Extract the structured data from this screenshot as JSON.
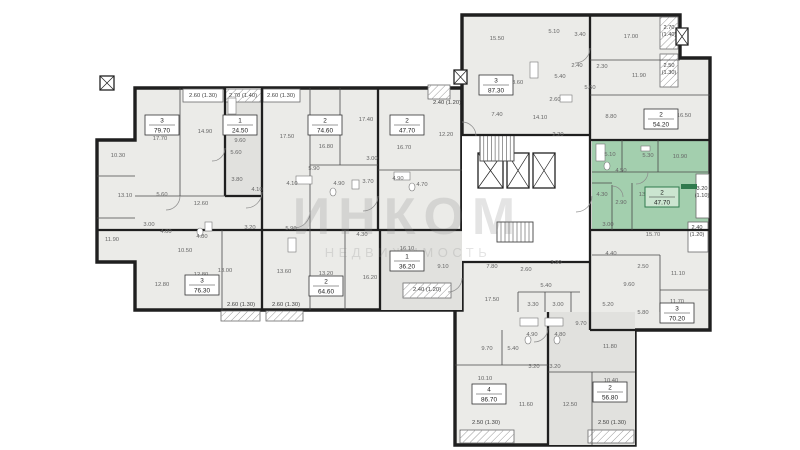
{
  "watermark": {
    "line1": "ИНКОМ",
    "line2": "НЕДВИЖИМОСТЬ"
  },
  "selected_unit": {
    "rooms": "2",
    "area": "47.70"
  },
  "colors": {
    "bg": "#ffffff",
    "wall": "#1f1f1f",
    "thin_wall": "#4a4a4a",
    "apt_fill": "#ebebe8",
    "alt_fill": "#e1e1de",
    "white": "#ffffff",
    "green": "#a3cfae",
    "green_dark": "#2f7a4d",
    "green_box": "#cbe5d0",
    "label": "#666666",
    "dim": "#3f3f3f",
    "watermark": "rgba(130,130,130,0.22)"
  },
  "plan": {
    "outlines": [
      {
        "name": "wing-upper-left",
        "points": "135,88 462,88 462,310 135,310 135,262 97,262 97,140 135,140"
      },
      {
        "name": "wing-right",
        "points": "462,15 680,15 680,58 710,58 710,330 635,330 635,445 455,445 455,310 462,310"
      }
    ],
    "regions": [
      {
        "x": 225,
        "y": 88,
        "w": 37,
        "h": 108,
        "fill": "alt"
      },
      {
        "x": 380,
        "y": 230,
        "w": 82,
        "h": 80,
        "fill": "alt"
      },
      {
        "x": 548,
        "y": 312,
        "w": 87,
        "h": 133,
        "fill": "alt"
      },
      {
        "x": 462,
        "y": 135,
        "w": 128,
        "h": 127,
        "fill": "white"
      },
      {
        "x": 592,
        "y": 140,
        "w": 116,
        "h": 90,
        "fill": "green"
      }
    ],
    "green_accent": {
      "x": 681,
      "y": 184,
      "w": 16,
      "h": 5
    },
    "balconies": [
      {
        "x": 183,
        "y": 89,
        "w": 40,
        "h": 13,
        "hatch": false
      },
      {
        "x": 225,
        "y": 89,
        "w": 36,
        "h": 13,
        "hatch": true
      },
      {
        "x": 263,
        "y": 89,
        "w": 37,
        "h": 13,
        "hatch": false
      },
      {
        "x": 660,
        "y": 17,
        "w": 18,
        "h": 32,
        "hatch": true
      },
      {
        "x": 660,
        "y": 54,
        "w": 18,
        "h": 33,
        "hatch": true
      },
      {
        "x": 428,
        "y": 85,
        "w": 22,
        "h": 14,
        "hatch": true
      },
      {
        "x": 221,
        "y": 311,
        "w": 39,
        "h": 10,
        "hatch": true
      },
      {
        "x": 266,
        "y": 311,
        "w": 37,
        "h": 10,
        "hatch": true
      },
      {
        "x": 403,
        "y": 283,
        "w": 48,
        "h": 15,
        "hatch": true
      },
      {
        "x": 696,
        "y": 174,
        "w": 13,
        "h": 44,
        "hatch": false
      },
      {
        "x": 688,
        "y": 222,
        "w": 20,
        "h": 30,
        "hatch": false
      },
      {
        "x": 460,
        "y": 430,
        "w": 54,
        "h": 13,
        "hatch": true
      },
      {
        "x": 588,
        "y": 430,
        "w": 46,
        "h": 13,
        "hatch": true
      }
    ],
    "shafts": [
      {
        "x": 478,
        "y": 153,
        "w": 25,
        "h": 35
      },
      {
        "x": 507,
        "y": 153,
        "w": 22,
        "h": 35
      },
      {
        "x": 533,
        "y": 153,
        "w": 22,
        "h": 35
      },
      {
        "x": 454,
        "y": 70,
        "w": 13,
        "h": 14
      },
      {
        "x": 100,
        "y": 76,
        "w": 14,
        "h": 14
      },
      {
        "x": 676,
        "y": 28,
        "w": 12,
        "h": 17
      }
    ],
    "stairs": [
      {
        "x": 480,
        "y": 135,
        "w": 34,
        "h": 26,
        "steps": 9
      },
      {
        "x": 497,
        "y": 222,
        "w": 36,
        "h": 20,
        "steps": 9
      }
    ],
    "walls_thick": [
      [
        225,
        88,
        225,
        196
      ],
      [
        262,
        88,
        262,
        310
      ],
      [
        378,
        88,
        378,
        230
      ],
      [
        97,
        230,
        462,
        230
      ],
      [
        380,
        230,
        380,
        310
      ],
      [
        225,
        196,
        262,
        196
      ],
      [
        590,
        15,
        590,
        330
      ],
      [
        462,
        135,
        590,
        135
      ],
      [
        590,
        140,
        710,
        140
      ],
      [
        590,
        230,
        710,
        230
      ],
      [
        462,
        262,
        590,
        262
      ],
      [
        548,
        312,
        548,
        445
      ],
      [
        590,
        330,
        635,
        330
      ]
    ],
    "walls_thin": [
      [
        180,
        88,
        180,
        196
      ],
      [
        310,
        88,
        310,
        230
      ],
      [
        340,
        88,
        340,
        165
      ],
      [
        310,
        165,
        378,
        165
      ],
      [
        378,
        170,
        462,
        170
      ],
      [
        135,
        196,
        225,
        196
      ],
      [
        97,
        176,
        135,
        176
      ],
      [
        97,
        218,
        135,
        218
      ],
      [
        222,
        230,
        222,
        310
      ],
      [
        310,
        230,
        310,
        310
      ],
      [
        345,
        230,
        345,
        310
      ],
      [
        592,
        172,
        708,
        172
      ],
      [
        622,
        140,
        622,
        172
      ],
      [
        658,
        140,
        658,
        172
      ],
      [
        612,
        185,
        612,
        230
      ],
      [
        632,
        183,
        632,
        230
      ],
      [
        592,
        183,
        612,
        183
      ],
      [
        590,
        60,
        680,
        60
      ],
      [
        590,
        95,
        710,
        95
      ],
      [
        518,
        292,
        518,
        312
      ],
      [
        545,
        292,
        545,
        312
      ],
      [
        571,
        292,
        571,
        312
      ],
      [
        518,
        292,
        580,
        292
      ],
      [
        455,
        365,
        548,
        365
      ],
      [
        502,
        330,
        502,
        365
      ],
      [
        548,
        372,
        635,
        372
      ],
      [
        592,
        372,
        592,
        445
      ],
      [
        592,
        255,
        660,
        255
      ],
      [
        660,
        255,
        660,
        312
      ],
      [
        660,
        290,
        710,
        290
      ]
    ],
    "doors": [
      "M262,192 A16,16 0 0 1 246,208",
      "M310,212 A16,16 0 0 1 294,228",
      "M378,196 A15,15 0 0 1 363,211",
      "M592,196 A16,16 0 0 1 576,212",
      "M648,172 A12,12 0 0 1 636,184",
      "M590,48 A15,15 0 0 1 575,63",
      "M548,328 A14,14 0 0 1 534,342",
      "M462,278 A14,14 0 0 1 448,292",
      "M225,148 A13,13 0 0 1 212,161",
      "M462,122 A14,14 0 0 1 476,136",
      "M612,186 A11,11 0 0 1 623,197",
      "M180,196 A14,14 0 0 1 166,210"
    ],
    "fixtures_rects": [
      [
        296,
        176,
        16,
        8
      ],
      [
        394,
        172,
        16,
        8
      ],
      [
        596,
        144,
        9,
        17
      ],
      [
        228,
        98,
        8,
        16
      ],
      [
        288,
        238,
        8,
        14
      ],
      [
        352,
        180,
        7,
        9
      ],
      [
        641,
        146,
        9,
        5
      ],
      [
        205,
        222,
        7,
        9
      ],
      [
        520,
        318,
        18,
        8
      ],
      [
        545,
        318,
        18,
        8
      ],
      [
        530,
        62,
        8,
        16
      ],
      [
        560,
        95,
        12,
        7
      ]
    ],
    "fixtures_ellipses": [
      [
        333,
        192
      ],
      [
        412,
        187
      ],
      [
        607,
        166
      ],
      [
        528,
        340
      ],
      [
        557,
        340
      ],
      [
        200,
        232
      ]
    ],
    "unit_boxes": [
      {
        "unit": "3",
        "area": "79.70",
        "x": 162,
        "y": 125,
        "selected": false
      },
      {
        "unit": "1",
        "area": "24.50",
        "x": 240,
        "y": 125,
        "selected": false
      },
      {
        "unit": "2",
        "area": "74.60",
        "x": 325,
        "y": 125,
        "selected": false
      },
      {
        "unit": "2",
        "area": "47.70",
        "x": 407,
        "y": 125,
        "selected": false
      },
      {
        "unit": "3",
        "area": "76.30",
        "x": 202,
        "y": 285,
        "selected": false
      },
      {
        "unit": "2",
        "area": "64.60",
        "x": 326,
        "y": 286,
        "selected": false
      },
      {
        "unit": "1",
        "area": "36.20",
        "x": 407,
        "y": 261,
        "selected": false
      },
      {
        "unit": "3",
        "area": "87.30",
        "x": 496,
        "y": 85,
        "selected": false
      },
      {
        "unit": "2",
        "area": "54.20",
        "x": 661,
        "y": 119,
        "selected": false
      },
      {
        "unit": "2",
        "area": "47.70",
        "x": 662,
        "y": 197,
        "selected": true
      },
      {
        "unit": "3",
        "area": "70.20",
        "x": 677,
        "y": 313,
        "selected": false
      },
      {
        "unit": "4",
        "area": "86.70",
        "x": 489,
        "y": 394,
        "selected": false
      },
      {
        "unit": "2",
        "area": "56.80",
        "x": 610,
        "y": 392,
        "selected": false
      }
    ],
    "room_labels": [
      [
        "10.30",
        118,
        157
      ],
      [
        "13.10",
        125,
        197
      ],
      [
        "11.90",
        112,
        241
      ],
      [
        "17.70",
        160,
        140
      ],
      [
        "14.90",
        205,
        133
      ],
      [
        "9.60",
        240,
        142
      ],
      [
        "5.60",
        236,
        154
      ],
      [
        "3.80",
        237,
        181
      ],
      [
        "4.10",
        257,
        191
      ],
      [
        "5.60",
        162,
        196
      ],
      [
        "12.60",
        201,
        205
      ],
      [
        "3.00",
        149,
        226
      ],
      [
        "4.00",
        166,
        233
      ],
      [
        "4.80",
        202,
        238
      ],
      [
        "10.50",
        185,
        252
      ],
      [
        "12.80",
        162,
        286
      ],
      [
        "12.80",
        201,
        276
      ],
      [
        "3.20",
        250,
        229
      ],
      [
        "13.00",
        225,
        272
      ],
      [
        "13.60",
        284,
        273
      ],
      [
        "5.90",
        314,
        170
      ],
      [
        "5.90",
        291,
        230
      ],
      [
        "4.90",
        339,
        185
      ],
      [
        "3.70",
        368,
        183
      ],
      [
        "3.00",
        372,
        160
      ],
      [
        "16.80",
        326,
        148
      ],
      [
        "17.50",
        287,
        138
      ],
      [
        "17.40",
        366,
        121
      ],
      [
        "16.70",
        404,
        149
      ],
      [
        "4.90",
        398,
        180
      ],
      [
        "4.70",
        422,
        186
      ],
      [
        "4.10",
        292,
        185
      ],
      [
        "4.30",
        362,
        236
      ],
      [
        "13.20",
        326,
        275
      ],
      [
        "16.20",
        370,
        279
      ],
      [
        "16.10",
        407,
        250
      ],
      [
        "9.10",
        443,
        268
      ],
      [
        "12.20",
        446,
        136
      ],
      [
        "15.50",
        497,
        40
      ],
      [
        "5.10",
        554,
        33
      ],
      [
        "3.40",
        580,
        36
      ],
      [
        "17.00",
        631,
        38
      ],
      [
        "2.40",
        577,
        67
      ],
      [
        "2.30",
        602,
        68
      ],
      [
        "11.90",
        639,
        77
      ],
      [
        "5.40",
        560,
        78
      ],
      [
        "5.60",
        590,
        89
      ],
      [
        "18.60",
        516,
        84
      ],
      [
        "2.60",
        555,
        101
      ],
      [
        "7.40",
        497,
        116
      ],
      [
        "14.10",
        540,
        119
      ],
      [
        "8.80",
        611,
        118
      ],
      [
        "16.50",
        684,
        117
      ],
      [
        "2.20",
        558,
        136
      ],
      [
        "5.10",
        610,
        156
      ],
      [
        "5.30",
        648,
        157
      ],
      [
        "10.90",
        680,
        158
      ],
      [
        "4.50",
        621,
        172
      ],
      [
        "4.30",
        602,
        196
      ],
      [
        "2.90",
        621,
        204
      ],
      [
        "13.80",
        646,
        196
      ],
      [
        "3.00",
        608,
        226
      ],
      [
        "15.70",
        653,
        236
      ],
      [
        "4.40",
        611,
        255
      ],
      [
        "2.50",
        643,
        268
      ],
      [
        "11.10",
        678,
        275
      ],
      [
        "9.60",
        629,
        286
      ],
      [
        "5.20",
        608,
        306
      ],
      [
        "5.80",
        643,
        314
      ],
      [
        "11.70",
        677,
        303
      ],
      [
        "7.80",
        492,
        268
      ],
      [
        "17.50",
        492,
        301
      ],
      [
        "3.30",
        533,
        306
      ],
      [
        "3.00",
        558,
        306
      ],
      [
        "9.70",
        581,
        325
      ],
      [
        "4.90",
        532,
        336
      ],
      [
        "4.80",
        560,
        336
      ],
      [
        "9.70",
        487,
        350
      ],
      [
        "5.40",
        513,
        350
      ],
      [
        "11.80",
        610,
        348
      ],
      [
        "3.20",
        534,
        368
      ],
      [
        "3.20",
        555,
        368
      ],
      [
        "10.10",
        485,
        380
      ],
      [
        "11.60",
        526,
        406
      ],
      [
        "12.50",
        570,
        406
      ],
      [
        "10.40",
        611,
        382
      ],
      [
        "3.90",
        556,
        264
      ],
      [
        "2.60",
        526,
        271
      ],
      [
        "5.40",
        546,
        287
      ]
    ],
    "dim_labels": [
      [
        "2.60 (1.30)",
        203,
        97
      ],
      [
        "2.70 (1.40)",
        243,
        97
      ],
      [
        "2.60 (1.30)",
        281,
        97
      ],
      [
        "2.60 (1.30)",
        241,
        306
      ],
      [
        "2.60 (1.30)",
        286,
        306
      ],
      [
        "2.40 (1.20)",
        427,
        291
      ],
      [
        "2.40 (1.20)",
        447,
        104
      ],
      [
        "2.50 (1.30)",
        486,
        424
      ],
      [
        "2.50 (1.30)",
        612,
        424
      ]
    ],
    "dim_labels_stacked": [
      [
        "2.70",
        "(1.40)",
        669,
        29
      ],
      [
        "2.50",
        "(1.30)",
        669,
        67
      ],
      [
        "3.20",
        "(1.10)",
        702,
        190
      ],
      [
        "2.40",
        "(1.20)",
        697,
        229
      ]
    ]
  }
}
